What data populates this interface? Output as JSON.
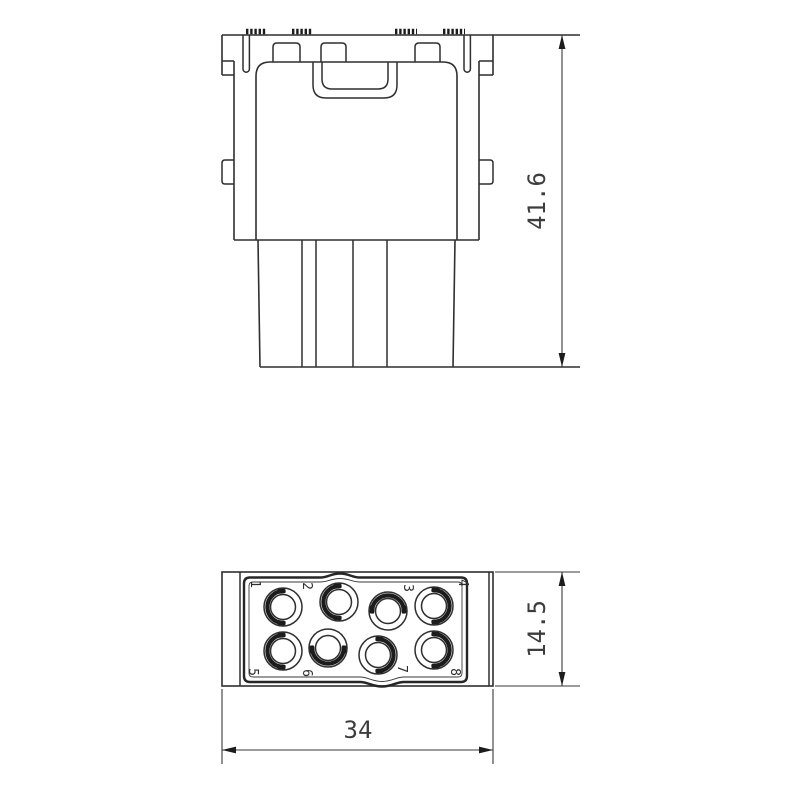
{
  "drawing": {
    "type": "technical-drawing-2-views",
    "views": {
      "front": {
        "label": "front-elevation-of-connector-module",
        "height_dimension": "41.6"
      },
      "bottom": {
        "label": "contact-face-view",
        "width_dimension": "34",
        "height_dimension": "14.5",
        "contact_numbers": [
          "1",
          "2",
          "3",
          "4",
          "5",
          "6",
          "7",
          "8"
        ]
      }
    },
    "colors": {
      "line": "#2f2f2f",
      "thick_line": "#1c1c1c",
      "background": "#ffffff"
    }
  }
}
